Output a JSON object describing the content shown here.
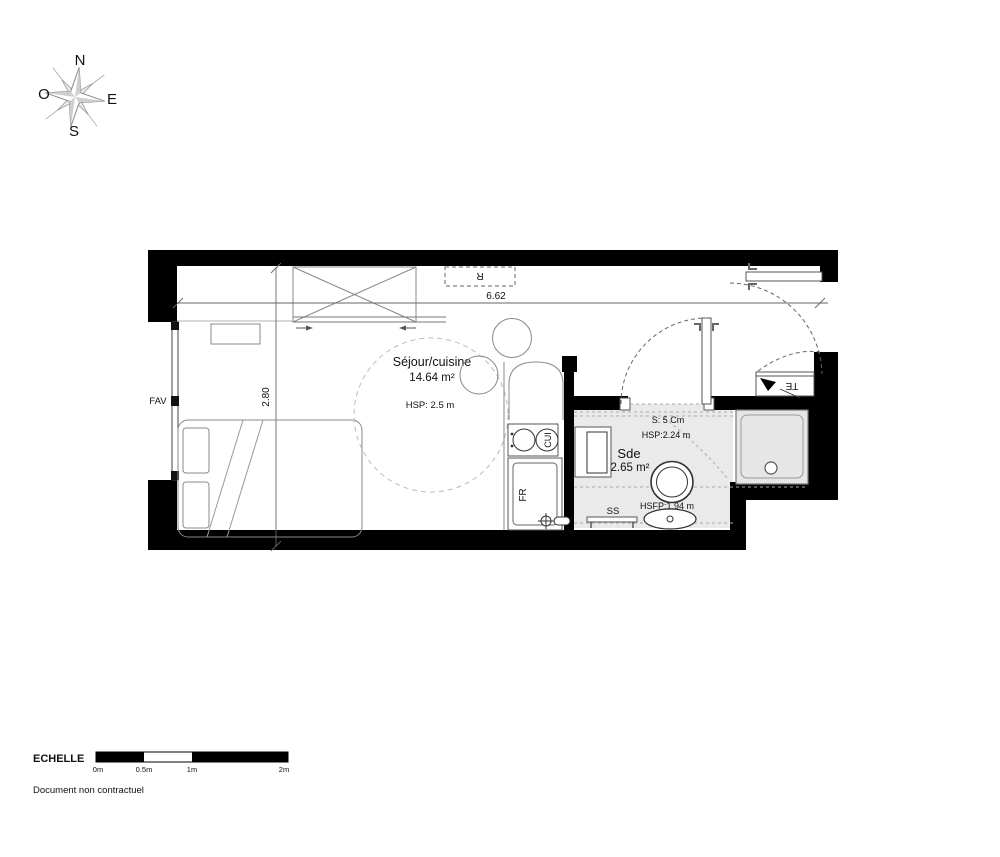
{
  "compass": {
    "n": "N",
    "e": "E",
    "s": "S",
    "o": "O"
  },
  "plan": {
    "living": {
      "name": "Séjour/cuisine",
      "area": "14.64 m²",
      "ceiling": "HSP: 2.5 m"
    },
    "bathroom": {
      "name": "Sde",
      "area": "2.65 m²",
      "ceiling": "HSP:2.24 m",
      "false_ceiling": "HSFP:1.94 m",
      "step": "S: 5 Cm"
    },
    "dimensions": {
      "width_m": "6.62",
      "depth_m": "2.80"
    },
    "labels": {
      "window": "FAV",
      "radiator": "R",
      "technical": "TE",
      "cooktop": "CUI",
      "fridge": "FR",
      "towel_rail": "SS"
    }
  },
  "scale_bar": {
    "title": "ECHELLE",
    "ticks": [
      "0m",
      "0.5m",
      "1m",
      "2m"
    ]
  },
  "footer": {
    "disclaimer": "Document non contractuel"
  },
  "colors": {
    "walls": "#000000",
    "bathroom_floor": "#eaeaea",
    "shower_tray": "#e6e6e6"
  }
}
